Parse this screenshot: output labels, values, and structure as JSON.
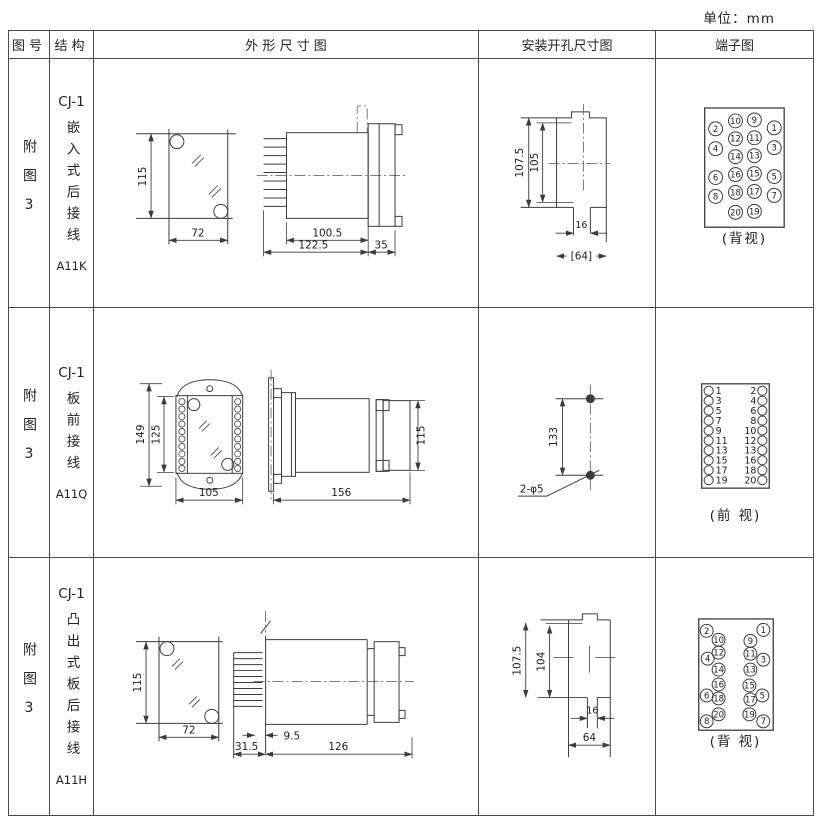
{
  "unit_note": "单位：mm",
  "columns": [
    "图号",
    "结构",
    "外 形 尺 寸 图",
    "安装开孔尺寸图",
    "端子图"
  ],
  "rows": [
    {
      "fig_no": "附图3",
      "model": "CJ-1",
      "structure_desc": "嵌入式后接线",
      "code": "A11K",
      "outline": {
        "height": "115",
        "width": "72",
        "body_len": "100.5",
        "total_len": "122.5",
        "flange_th": "35"
      },
      "install": {
        "outer_v": "107.5",
        "inner_v": "105",
        "slot_w": "16",
        "opening_w": "[64]"
      },
      "terminal_caption": "(背视)"
    },
    {
      "fig_no": "附图3",
      "model": "CJ-1",
      "structure_desc": "板前接线",
      "code": "A11Q",
      "outline": {
        "total_h": "149",
        "inner_h": "125",
        "width": "105",
        "side_len": "156",
        "side_h": "115"
      },
      "install": {
        "hole_spacing": "133",
        "hole_note": "2-φ5"
      },
      "terminal_caption": "(前 视)"
    },
    {
      "fig_no": "附图3",
      "model": "CJ-1",
      "structure_desc": "凸出式板后接线",
      "code": "A11H",
      "outline": {
        "height": "115",
        "width": "72",
        "pin_len": "31.5",
        "gap": "9.5",
        "body_len": "126"
      },
      "install": {
        "outer_v": "107.5",
        "inner_v": "104",
        "slot_w": "16",
        "opening_w": "64"
      },
      "terminal_caption": "(背 视)"
    }
  ],
  "terminal_diagrams": [
    {
      "svg": "terminal-svg-r1",
      "r": 7,
      "dy": 3,
      "cls": "tn s1",
      "items": [
        {
          "n": "2",
          "x": 715,
          "y": 128
        },
        {
          "n": "10",
          "x": 735,
          "y": 120
        },
        {
          "n": "9",
          "x": 754,
          "y": 119
        },
        {
          "n": "1",
          "x": 774,
          "y": 127
        },
        {
          "n": "4",
          "x": 715,
          "y": 148
        },
        {
          "n": "12",
          "x": 735,
          "y": 138
        },
        {
          "n": "11",
          "x": 754,
          "y": 137
        },
        {
          "n": "3",
          "x": 774,
          "y": 147
        },
        {
          "n": "14",
          "x": 735,
          "y": 156
        },
        {
          "n": "13",
          "x": 754,
          "y": 155
        },
        {
          "n": "6",
          "x": 715,
          "y": 177
        },
        {
          "n": "16",
          "x": 735,
          "y": 174
        },
        {
          "n": "15",
          "x": 754,
          "y": 173
        },
        {
          "n": "5",
          "x": 774,
          "y": 176
        },
        {
          "n": "8",
          "x": 715,
          "y": 196
        },
        {
          "n": "18",
          "x": 735,
          "y": 192
        },
        {
          "n": "17",
          "x": 754,
          "y": 191
        },
        {
          "n": "7",
          "x": 774,
          "y": 195
        },
        {
          "n": "20",
          "x": 735,
          "y": 212
        },
        {
          "n": "19",
          "x": 754,
          "y": 211
        }
      ]
    },
    {
      "svg": "terminal-svg-r2",
      "r": 4.6,
      "dy": 3.4,
      "cls": "tn s2",
      "items": [
        {
          "n": "1",
          "x": 708,
          "tx": 715,
          "a": "start",
          "y": 390
        },
        {
          "n": "2",
          "x": 762,
          "tx": 756,
          "a": "end",
          "y": 390
        },
        {
          "n": "3",
          "x": 708,
          "tx": 715,
          "a": "start",
          "y": 400
        },
        {
          "n": "4",
          "x": 762,
          "tx": 756,
          "a": "end",
          "y": 400
        },
        {
          "n": "5",
          "x": 708,
          "tx": 715,
          "a": "start",
          "y": 410
        },
        {
          "n": "6",
          "x": 762,
          "tx": 756,
          "a": "end",
          "y": 410
        },
        {
          "n": "7",
          "x": 708,
          "tx": 715,
          "a": "start",
          "y": 420
        },
        {
          "n": "8",
          "x": 762,
          "tx": 756,
          "a": "end",
          "y": 420
        },
        {
          "n": "9",
          "x": 708,
          "tx": 715,
          "a": "start",
          "y": 430
        },
        {
          "n": "10",
          "x": 762,
          "tx": 756,
          "a": "end",
          "y": 430
        },
        {
          "n": "11",
          "x": 708,
          "tx": 715,
          "a": "start",
          "y": 440
        },
        {
          "n": "12",
          "x": 762,
          "tx": 756,
          "a": "end",
          "y": 440
        },
        {
          "n": "13",
          "x": 708,
          "tx": 715,
          "a": "start",
          "y": 450
        },
        {
          "n": "13",
          "x": 762,
          "tx": 756,
          "a": "end",
          "y": 450
        },
        {
          "n": "15",
          "x": 708,
          "tx": 715,
          "a": "start",
          "y": 460
        },
        {
          "n": "16",
          "x": 762,
          "tx": 756,
          "a": "end",
          "y": 460
        },
        {
          "n": "17",
          "x": 708,
          "tx": 715,
          "a": "start",
          "y": 470
        },
        {
          "n": "18",
          "x": 762,
          "tx": 756,
          "a": "end",
          "y": 470
        },
        {
          "n": "19",
          "x": 708,
          "tx": 715,
          "a": "start",
          "y": 480
        },
        {
          "n": "20",
          "x": 762,
          "tx": 756,
          "a": "end",
          "y": 480
        }
      ]
    },
    {
      "svg": "terminal-svg-r3",
      "r": 6.5,
      "dy": 3,
      "cls": "tn s1",
      "items": [
        {
          "n": "2",
          "x": 706,
          "y": 630
        },
        {
          "n": "1",
          "x": 763,
          "y": 629
        },
        {
          "n": "10",
          "x": 718,
          "y": 639
        },
        {
          "n": "9",
          "x": 750,
          "y": 640
        },
        {
          "n": "12",
          "x": 718,
          "y": 652
        },
        {
          "n": "11",
          "x": 750,
          "y": 653
        },
        {
          "n": "4",
          "x": 707,
          "y": 658
        },
        {
          "n": "3",
          "x": 763,
          "y": 659
        },
        {
          "n": "14",
          "x": 718,
          "y": 669
        },
        {
          "n": "13",
          "x": 750,
          "y": 669
        },
        {
          "n": "16",
          "x": 718,
          "y": 684
        },
        {
          "n": "15",
          "x": 749,
          "y": 685
        },
        {
          "n": "6",
          "x": 706,
          "y": 695
        },
        {
          "n": "5",
          "x": 762,
          "y": 695
        },
        {
          "n": "18",
          "x": 718,
          "y": 698
        },
        {
          "n": "17",
          "x": 750,
          "y": 699
        },
        {
          "n": "20",
          "x": 718,
          "y": 714
        },
        {
          "n": "19",
          "x": 749,
          "y": 714
        },
        {
          "n": "8",
          "x": 706,
          "y": 721
        },
        {
          "n": "7",
          "x": 763,
          "y": 721
        }
      ]
    }
  ]
}
